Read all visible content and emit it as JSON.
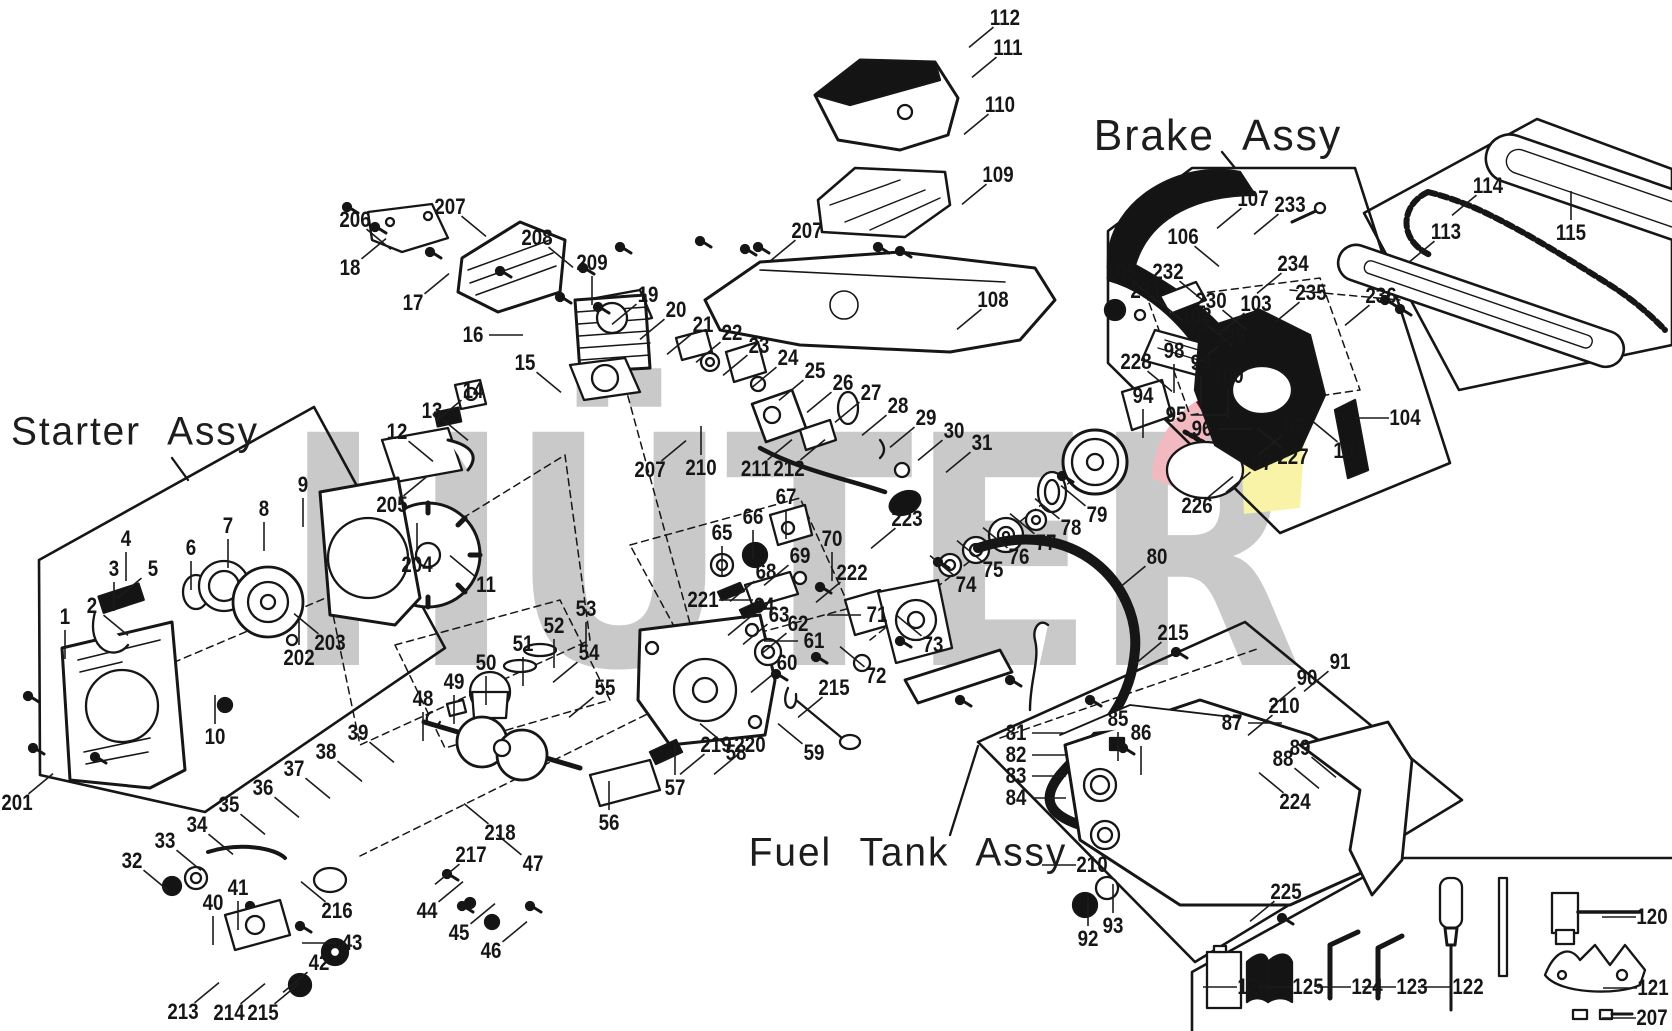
{
  "watermark": {
    "text": "HÜTER",
    "color": "#c9c9c9"
  },
  "logo_colors": {
    "pink": "#f3b9c1",
    "dark_red": "#6e1116",
    "yellow": "#f8f3a6",
    "red": "#e05560"
  },
  "assemblies": [
    {
      "id": "starter",
      "label": "Starter Assy",
      "x": 135,
      "y": 432
    },
    {
      "id": "brake",
      "label": "Brake Assy",
      "x": 1218,
      "y": 136
    },
    {
      "id": "fuel",
      "label": "Fuel Tank Assy",
      "x": 908,
      "y": 853
    }
  ],
  "part_labels": [
    {
      "t": "112",
      "x": 1005,
      "y": 18,
      "d": "dl"
    },
    {
      "t": "111",
      "x": 1008,
      "y": 48,
      "d": "dl"
    },
    {
      "t": "110",
      "x": 1000,
      "y": 105,
      "d": "dl"
    },
    {
      "t": "109",
      "x": 998,
      "y": 175,
      "d": "dl"
    },
    {
      "t": "207",
      "x": 807,
      "y": 231,
      "d": "dl"
    },
    {
      "t": "206",
      "x": 355,
      "y": 220,
      "d": "dr"
    },
    {
      "t": "207",
      "x": 450,
      "y": 207,
      "d": "dr"
    },
    {
      "t": "18",
      "x": 350,
      "y": 268,
      "d": "ur"
    },
    {
      "t": "17",
      "x": 413,
      "y": 303,
      "d": "ur"
    },
    {
      "t": "208",
      "x": 537,
      "y": 238,
      "d": "dr"
    },
    {
      "t": "16",
      "x": 473,
      "y": 335,
      "d": "r"
    },
    {
      "t": "209",
      "x": 592,
      "y": 263,
      "d": "d"
    },
    {
      "t": "19",
      "x": 648,
      "y": 295,
      "d": "dl"
    },
    {
      "t": "20",
      "x": 676,
      "y": 310,
      "d": "dl"
    },
    {
      "t": "21",
      "x": 703,
      "y": 325,
      "d": "dl"
    },
    {
      "t": "22",
      "x": 732,
      "y": 333,
      "d": "dl"
    },
    {
      "t": "23",
      "x": 759,
      "y": 346,
      "d": "dl"
    },
    {
      "t": "24",
      "x": 788,
      "y": 358,
      "d": "dl"
    },
    {
      "t": "25",
      "x": 815,
      "y": 371,
      "d": "dl"
    },
    {
      "t": "26",
      "x": 843,
      "y": 383,
      "d": "dl"
    },
    {
      "t": "27",
      "x": 871,
      "y": 393,
      "d": "dl"
    },
    {
      "t": "28",
      "x": 898,
      "y": 406,
      "d": "dl"
    },
    {
      "t": "29",
      "x": 926,
      "y": 418,
      "d": "dl"
    },
    {
      "t": "30",
      "x": 954,
      "y": 431,
      "d": "dl"
    },
    {
      "t": "31",
      "x": 982,
      "y": 443,
      "d": "dl"
    },
    {
      "t": "108",
      "x": 993,
      "y": 300,
      "d": "dl"
    },
    {
      "t": "15",
      "x": 525,
      "y": 363,
      "d": "dr"
    },
    {
      "t": "14",
      "x": 473,
      "y": 391,
      "d": "dl"
    },
    {
      "t": "13",
      "x": 432,
      "y": 411,
      "d": "dr"
    },
    {
      "t": "12",
      "x": 397,
      "y": 432,
      "d": "dr"
    },
    {
      "t": "205",
      "x": 392,
      "y": 505,
      "d": "ur"
    },
    {
      "t": "204",
      "x": 417,
      "y": 565,
      "d": "u"
    },
    {
      "t": "11",
      "x": 486,
      "y": 585,
      "d": "ul"
    },
    {
      "t": "1",
      "x": 65,
      "y": 617,
      "d": "d"
    },
    {
      "t": "2",
      "x": 92,
      "y": 606,
      "d": "dr"
    },
    {
      "t": "3",
      "x": 114,
      "y": 569,
      "d": "d"
    },
    {
      "t": "4",
      "x": 126,
      "y": 539,
      "d": "d"
    },
    {
      "t": "5",
      "x": 153,
      "y": 569,
      "d": "dl"
    },
    {
      "t": "6",
      "x": 191,
      "y": 548,
      "d": "d"
    },
    {
      "t": "7",
      "x": 228,
      "y": 526,
      "d": "d"
    },
    {
      "t": "8",
      "x": 264,
      "y": 509,
      "d": "d"
    },
    {
      "t": "9",
      "x": 303,
      "y": 485,
      "d": "d"
    },
    {
      "t": "10",
      "x": 215,
      "y": 737,
      "d": "u"
    },
    {
      "t": "202",
      "x": 299,
      "y": 658,
      "d": "u"
    },
    {
      "t": "203",
      "x": 330,
      "y": 643,
      "d": "ul"
    },
    {
      "t": "201",
      "x": 17,
      "y": 803,
      "d": "ur"
    },
    {
      "t": "207",
      "x": 650,
      "y": 470,
      "d": "ur"
    },
    {
      "t": "210",
      "x": 701,
      "y": 468,
      "d": "u"
    },
    {
      "t": "211",
      "x": 756,
      "y": 469,
      "d": "ur"
    },
    {
      "t": "212",
      "x": 789,
      "y": 469,
      "d": "ur"
    },
    {
      "t": "65",
      "x": 722,
      "y": 533,
      "d": "d"
    },
    {
      "t": "66",
      "x": 753,
      "y": 517,
      "d": "d"
    },
    {
      "t": "67",
      "x": 786,
      "y": 497,
      "d": "d"
    },
    {
      "t": "68",
      "x": 766,
      "y": 572,
      "d": "dl"
    },
    {
      "t": "69",
      "x": 800,
      "y": 556,
      "d": "dl"
    },
    {
      "t": "70",
      "x": 832,
      "y": 539,
      "d": "d"
    },
    {
      "t": "221",
      "x": 703,
      "y": 600,
      "d": "r"
    },
    {
      "t": "64",
      "x": 764,
      "y": 606,
      "d": "dl"
    },
    {
      "t": "63",
      "x": 779,
      "y": 615,
      "d": "dl"
    },
    {
      "t": "62",
      "x": 798,
      "y": 624,
      "d": "dl"
    },
    {
      "t": "61",
      "x": 814,
      "y": 641,
      "d": "l"
    },
    {
      "t": "60",
      "x": 787,
      "y": 663,
      "d": "dl"
    },
    {
      "t": "222",
      "x": 852,
      "y": 573,
      "d": "dl"
    },
    {
      "t": "71",
      "x": 877,
      "y": 615,
      "d": "l"
    },
    {
      "t": "72",
      "x": 876,
      "y": 676,
      "d": "ul"
    },
    {
      "t": "223",
      "x": 907,
      "y": 519,
      "d": "dl"
    },
    {
      "t": "215",
      "x": 834,
      "y": 688,
      "d": "dl"
    },
    {
      "t": "73",
      "x": 933,
      "y": 645,
      "d": "ul"
    },
    {
      "t": "74",
      "x": 966,
      "y": 585,
      "d": "ul"
    },
    {
      "t": "75",
      "x": 993,
      "y": 570,
      "d": "ul"
    },
    {
      "t": "76",
      "x": 1019,
      "y": 557,
      "d": "ul"
    },
    {
      "t": "77",
      "x": 1046,
      "y": 543,
      "d": "ul"
    },
    {
      "t": "78",
      "x": 1071,
      "y": 528,
      "d": "ul"
    },
    {
      "t": "79",
      "x": 1097,
      "y": 515,
      "d": "ul"
    },
    {
      "t": "80",
      "x": 1157,
      "y": 557,
      "d": "dl"
    },
    {
      "t": "226",
      "x": 1197,
      "y": 506,
      "d": "ur"
    },
    {
      "t": "215",
      "x": 1173,
      "y": 633,
      "d": "dl"
    },
    {
      "t": "32",
      "x": 132,
      "y": 861,
      "d": "dr"
    },
    {
      "t": "33",
      "x": 165,
      "y": 841,
      "d": "dr"
    },
    {
      "t": "34",
      "x": 197,
      "y": 825,
      "d": "dr"
    },
    {
      "t": "35",
      "x": 229,
      "y": 805,
      "d": "dr"
    },
    {
      "t": "36",
      "x": 263,
      "y": 788,
      "d": "dr"
    },
    {
      "t": "37",
      "x": 294,
      "y": 769,
      "d": "dr"
    },
    {
      "t": "38",
      "x": 326,
      "y": 752,
      "d": "dr"
    },
    {
      "t": "39",
      "x": 358,
      "y": 733,
      "d": "dr"
    },
    {
      "t": "40",
      "x": 213,
      "y": 903,
      "d": "d"
    },
    {
      "t": "41",
      "x": 238,
      "y": 888,
      "d": "d"
    },
    {
      "t": "42",
      "x": 319,
      "y": 963,
      "d": "dl"
    },
    {
      "t": "43",
      "x": 352,
      "y": 943,
      "d": "l"
    },
    {
      "t": "44",
      "x": 427,
      "y": 911,
      "d": "ur"
    },
    {
      "t": "45",
      "x": 459,
      "y": 933,
      "d": "ur"
    },
    {
      "t": "46",
      "x": 491,
      "y": 951,
      "d": "ur"
    },
    {
      "t": "213",
      "x": 183,
      "y": 1012,
      "d": "ur"
    },
    {
      "t": "214",
      "x": 229,
      "y": 1013,
      "d": "ur"
    },
    {
      "t": "215",
      "x": 263,
      "y": 1013,
      "d": "ur"
    },
    {
      "t": "216",
      "x": 337,
      "y": 911,
      "d": "ul"
    },
    {
      "t": "217",
      "x": 471,
      "y": 855,
      "d": "dl"
    },
    {
      "t": "218",
      "x": 500,
      "y": 833,
      "d": "ul"
    },
    {
      "t": "47",
      "x": 533,
      "y": 864,
      "d": "ul"
    },
    {
      "t": "48",
      "x": 423,
      "y": 699,
      "d": "d"
    },
    {
      "t": "49",
      "x": 454,
      "y": 682,
      "d": "d"
    },
    {
      "t": "50",
      "x": 486,
      "y": 663,
      "d": "d"
    },
    {
      "t": "51",
      "x": 523,
      "y": 644,
      "d": "d"
    },
    {
      "t": "52",
      "x": 554,
      "y": 626,
      "d": "d"
    },
    {
      "t": "53",
      "x": 586,
      "y": 609,
      "d": "d"
    },
    {
      "t": "54",
      "x": 589,
      "y": 653,
      "d": "dl"
    },
    {
      "t": "55",
      "x": 605,
      "y": 688,
      "d": "dl"
    },
    {
      "t": "219",
      "x": 716,
      "y": 745,
      "d": "dl"
    },
    {
      "t": "220",
      "x": 750,
      "y": 745,
      "d": "dl"
    },
    {
      "t": "56",
      "x": 609,
      "y": 823,
      "d": "u"
    },
    {
      "t": "57",
      "x": 675,
      "y": 788,
      "d": "u"
    },
    {
      "t": "58",
      "x": 736,
      "y": 753,
      "d": "ul"
    },
    {
      "t": "59",
      "x": 814,
      "y": 753,
      "d": "ul"
    },
    {
      "t": "105",
      "x": 1121,
      "y": 272,
      "d": "dr"
    },
    {
      "t": "231",
      "x": 1146,
      "y": 291,
      "d": "dr"
    },
    {
      "t": "232",
      "x": 1168,
      "y": 272,
      "d": "dr"
    },
    {
      "t": "106",
      "x": 1183,
      "y": 237,
      "d": "dr"
    },
    {
      "t": "107",
      "x": 1253,
      "y": 199,
      "d": "dl"
    },
    {
      "t": "233",
      "x": 1290,
      "y": 205,
      "d": "dl"
    },
    {
      "t": "230",
      "x": 1211,
      "y": 301,
      "d": "dr"
    },
    {
      "t": "102",
      "x": 1196,
      "y": 316,
      "d": "dr"
    },
    {
      "t": "234",
      "x": 1293,
      "y": 264,
      "d": "dl"
    },
    {
      "t": "103",
      "x": 1256,
      "y": 304,
      "d": "dl"
    },
    {
      "t": "235",
      "x": 1311,
      "y": 293,
      "d": "dl"
    },
    {
      "t": "229",
      "x": 1230,
      "y": 337,
      "d": "dl"
    },
    {
      "t": "98",
      "x": 1174,
      "y": 351,
      "d": "d"
    },
    {
      "t": "99",
      "x": 1201,
      "y": 363,
      "d": "d"
    },
    {
      "t": "100",
      "x": 1228,
      "y": 376,
      "d": "d"
    },
    {
      "t": "228",
      "x": 1136,
      "y": 362,
      "d": "dr"
    },
    {
      "t": "94",
      "x": 1143,
      "y": 396,
      "d": "d"
    },
    {
      "t": "95",
      "x": 1176,
      "y": 415,
      "d": "r"
    },
    {
      "t": "96",
      "x": 1202,
      "y": 429,
      "d": "r"
    },
    {
      "t": "62",
      "x": 1294,
      "y": 426,
      "d": "dl"
    },
    {
      "t": "227",
      "x": 1293,
      "y": 457,
      "d": "ul"
    },
    {
      "t": "97",
      "x": 1262,
      "y": 463,
      "d": "dl"
    },
    {
      "t": "101",
      "x": 1349,
      "y": 451,
      "d": "ul"
    },
    {
      "t": "104",
      "x": 1405,
      "y": 418,
      "d": "l"
    },
    {
      "t": "113",
      "x": 1446,
      "y": 232,
      "d": "dl"
    },
    {
      "t": "114",
      "x": 1488,
      "y": 186,
      "d": "dl"
    },
    {
      "t": "115",
      "x": 1571,
      "y": 233,
      "d": "u"
    },
    {
      "t": "236",
      "x": 1381,
      "y": 296,
      "d": "dl"
    },
    {
      "t": "81",
      "x": 1016,
      "y": 733,
      "d": "r"
    },
    {
      "t": "82",
      "x": 1016,
      "y": 755,
      "d": "r"
    },
    {
      "t": "83",
      "x": 1016,
      "y": 776,
      "d": "r"
    },
    {
      "t": "84",
      "x": 1016,
      "y": 798,
      "d": "r"
    },
    {
      "t": "85",
      "x": 1118,
      "y": 719,
      "d": "d"
    },
    {
      "t": "86",
      "x": 1141,
      "y": 733,
      "d": "d"
    },
    {
      "t": "87",
      "x": 1232,
      "y": 723,
      "d": "r"
    },
    {
      "t": "210",
      "x": 1284,
      "y": 706,
      "d": "dl"
    },
    {
      "t": "90",
      "x": 1307,
      "y": 678,
      "d": "dl"
    },
    {
      "t": "91",
      "x": 1340,
      "y": 662,
      "d": "dl"
    },
    {
      "t": "88",
      "x": 1283,
      "y": 759,
      "d": "dr"
    },
    {
      "t": "89",
      "x": 1300,
      "y": 748,
      "d": "dr"
    },
    {
      "t": "224",
      "x": 1295,
      "y": 802,
      "d": "ul"
    },
    {
      "t": "210",
      "x": 1092,
      "y": 865,
      "d": "l"
    },
    {
      "t": "225",
      "x": 1286,
      "y": 892,
      "d": "dl"
    },
    {
      "t": "92",
      "x": 1088,
      "y": 939,
      "d": "u"
    },
    {
      "t": "93",
      "x": 1113,
      "y": 926,
      "d": "u"
    },
    {
      "t": "120",
      "x": 1652,
      "y": 917,
      "d": "l"
    },
    {
      "t": "121",
      "x": 1653,
      "y": 988,
      "d": "l"
    },
    {
      "t": "122",
      "x": 1468,
      "y": 987,
      "d": "l"
    },
    {
      "t": "123",
      "x": 1412,
      "y": 987,
      "d": "l"
    },
    {
      "t": "124",
      "x": 1367,
      "y": 987,
      "d": "l"
    },
    {
      "t": "125",
      "x": 1308,
      "y": 987,
      "d": "l"
    },
    {
      "t": "126",
      "x": 1253,
      "y": 987,
      "d": "l"
    },
    {
      "t": "207",
      "x": 1652,
      "y": 1018,
      "d": "l"
    }
  ]
}
